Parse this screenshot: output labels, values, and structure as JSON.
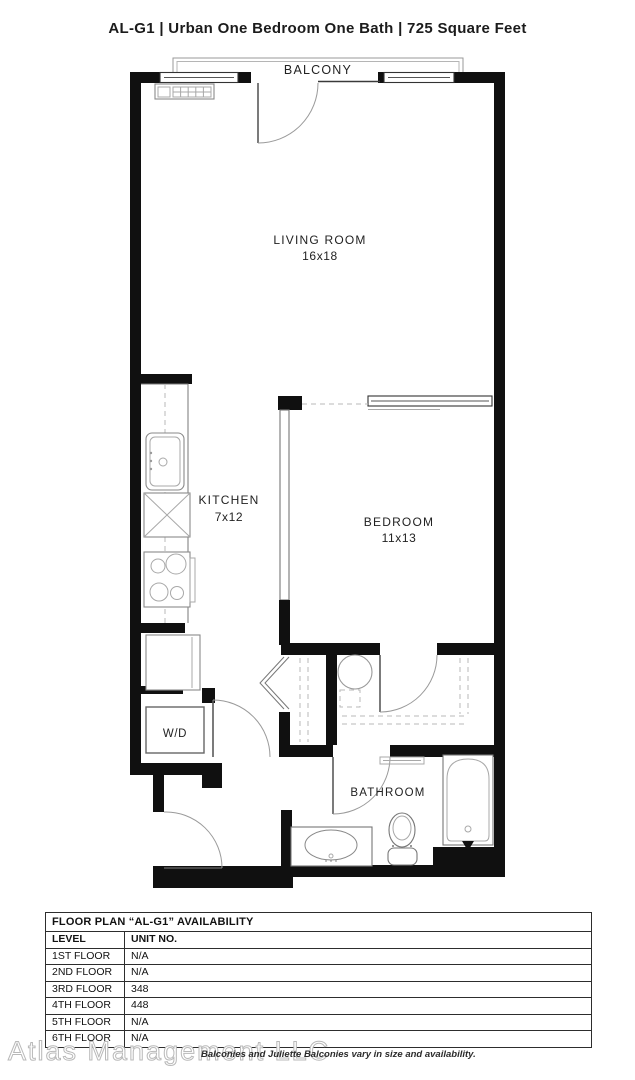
{
  "title": "AL-G1 | Urban One Bedroom One Bath | 725 Square Feet",
  "colors": {
    "wall": "#101010",
    "fixture_line": "#8a8a8a",
    "dash_line": "#b9b9b9",
    "watermark": "#b9b9b9",
    "text": "#222222"
  },
  "floor_plan": {
    "labels": {
      "balcony": "BALCONY",
      "living_room": "LIVING ROOM",
      "living_room_dims": "16x18",
      "kitchen": "KITCHEN",
      "kitchen_dims": "7x12",
      "bedroom": "BEDROOM",
      "bedroom_dims": "11x13",
      "washer_dryer": "W/D",
      "bathroom": "BATHROOM"
    }
  },
  "availability_table": {
    "title": "FLOOR PLAN “AL-G1” AVAILABILITY",
    "columns": {
      "level": "LEVEL",
      "unit": "UNIT NO."
    },
    "rows": [
      {
        "level": "1ST FLOOR",
        "unit": "N/A"
      },
      {
        "level": "2ND FLOOR",
        "unit": "N/A"
      },
      {
        "level": "3RD FLOOR",
        "unit": "348"
      },
      {
        "level": "4TH FLOOR",
        "unit": "448"
      },
      {
        "level": "5TH FLOOR",
        "unit": "N/A"
      },
      {
        "level": "6TH FLOOR",
        "unit": "N/A"
      }
    ]
  },
  "footer": {
    "watermark": "Atlas Management LLC",
    "disclaimer": "Balconies and Juliette Balconies vary in size and availability."
  }
}
